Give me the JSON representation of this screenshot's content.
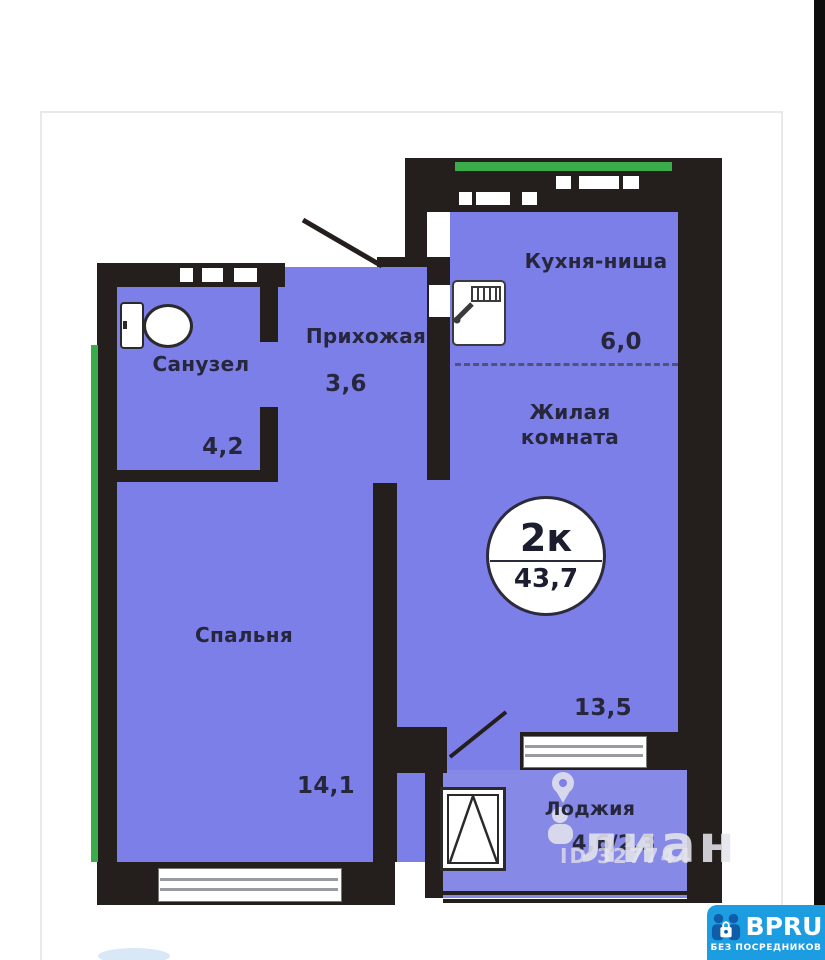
{
  "plan": {
    "rooms": {
      "kitchen": {
        "label": "Кухня-ниша",
        "area": "6,0"
      },
      "living": {
        "label_line1": "Жилая",
        "label_line2": "комната",
        "area": "13,5"
      },
      "hallway": {
        "label": "Прихожая",
        "area": "3,6"
      },
      "bathroom": {
        "label": "Санузел",
        "area": "4,2"
      },
      "bedroom": {
        "label": "Спальня",
        "area": "14,1"
      },
      "loggia": {
        "label": "Лоджия",
        "area": "4,6/2,3"
      }
    },
    "badge": {
      "room_count": "2к",
      "total_area": "43,7"
    }
  },
  "watermark": {
    "name": "лиан",
    "id": "ID 327744"
  },
  "brand": {
    "name": "BPRU",
    "tagline": "БЕЗ ПОСРЕДНИКОВ"
  },
  "colors": {
    "floor_fill": "#7d7fe9",
    "wall": "#241f1d",
    "accent_green": "#3aad4a",
    "brand_blue": "#1c9ce1",
    "brand_dark_blue": "#0f5ca8"
  }
}
